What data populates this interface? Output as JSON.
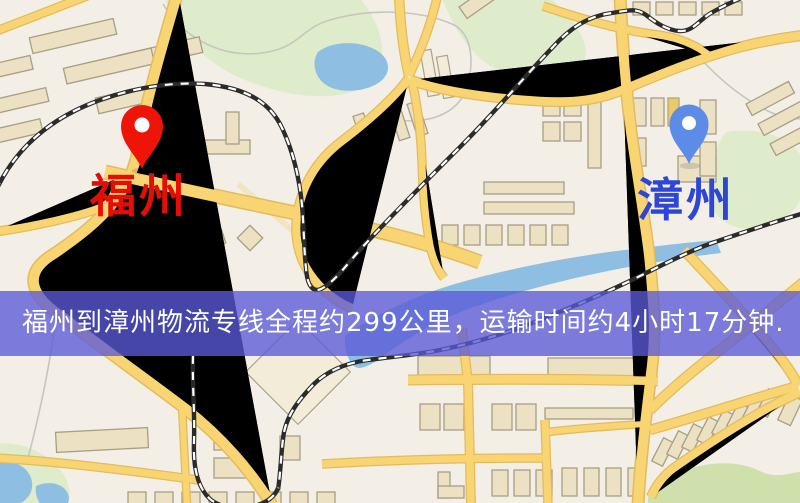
{
  "window": {
    "width": 800,
    "height": 503
  },
  "map": {
    "type": "road-map-illustration",
    "colors": {
      "background": "#f3efe7",
      "road": "#f8d572",
      "road_casing": "#e2bb5e",
      "building": "#ece1c2",
      "building_outline": "#a79e85",
      "park": "#dfeccb",
      "park_dark": "#cfe0ac",
      "water": "#8ebfe2",
      "railway": "#2b2b2b"
    },
    "origin": {
      "name": "福州",
      "pin_color": "#ee1508",
      "text_color": "#e60d05"
    },
    "destination": {
      "name": "漳州",
      "pin_color": "#5d8ce8",
      "text_color": "#2e46d6"
    }
  },
  "banner": {
    "text": "福州到漳州物流专线全程约299公里，运输时间约4小时17分钟.",
    "background_color": "rgba(90,90,216,0.78)",
    "text_color": "#ffffff"
  }
}
